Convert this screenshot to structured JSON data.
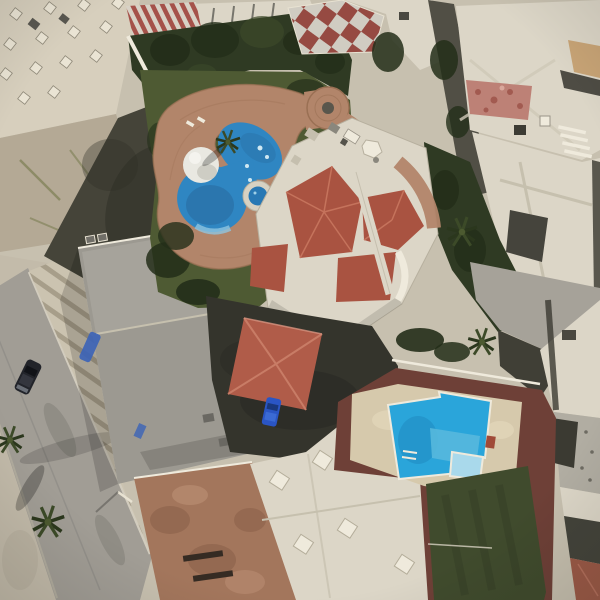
{
  "meta": {
    "title": "Aerial satellite view of a residential block with a resort-style pool, villa with red tile roofs, and a second backyard pool",
    "type": "satellite-photo",
    "width": 600,
    "height": 600
  },
  "scene": {
    "landmarks": [
      {
        "name": "resort-pool",
        "description": "Free-form blue swimming pool with white dome palapa and round spa"
      },
      {
        "name": "pool-deck",
        "description": "Terracotta brick pool deck with circular plaza and fountain"
      },
      {
        "name": "villa",
        "description": "White villa with red tile hip roofs and rooftop terraces"
      },
      {
        "name": "tree-garden",
        "description": "Dense dark green tree garden north of the pool"
      },
      {
        "name": "checkerboard-patio",
        "description": "Red and white checkerboard patio at top center"
      },
      {
        "name": "street",
        "description": "Gray street along the west side with a parked dark sedan and palm trees"
      },
      {
        "name": "striped-sidewalk",
        "description": "Wide sidewalk with diagonal paving stripes"
      },
      {
        "name": "gray-rooftop",
        "description": "Large flat gray rooftop building beside the street"
      },
      {
        "name": "red-pavilion",
        "description": "Red hip-roof pavilion over a dark driveway with a blue car"
      },
      {
        "name": "second-pool",
        "description": "Bright blue backyard pool with steps on a tan deck"
      },
      {
        "name": "turf-lawn",
        "description": "Dark green artificial turf lawn bordered by maroon walkways"
      },
      {
        "name": "white-rooftops",
        "description": "Flat white rooftops with water tanks and parapet walls"
      },
      {
        "name": "brown-rooftop",
        "description": "Mottled brown rooftop with dark vent slots"
      },
      {
        "name": "pink-roof-patch",
        "description": "Mottled pink tiled patch on a white roof, upper right"
      }
    ],
    "colors": {
      "base": "#c7c0af",
      "road": "#a19d95",
      "roadEdge": "#d8d2c3",
      "sidewalk": "#c3bbaa",
      "stripeLight": "#cbc3b0",
      "stripeDark": "#a79e8a",
      "tanRoof": "#d7cfbd",
      "ventLight": "#eae4d4",
      "acDark": "#595750",
      "weathered": "#b4a995",
      "moss": "#7c7f53",
      "darkShadow": "#454439",
      "darkest": "#2d2d26",
      "grayRoof": "#9c9991",
      "grayRoofLight": "#adaaa1",
      "garden": "#2f3a23",
      "gardenDark": "#232e19",
      "gardenLight": "#3c4929",
      "grass": "#4e5a33",
      "brick": "#b2856a",
      "brickDark": "#9a7054",
      "poolBlue": "#2f86c2",
      "poolDeep": "#28699f",
      "poolLight": "#8fc4e0",
      "poolFoam": "#cfe8f2",
      "domeWhite": "#e9e8e1",
      "domeShade": "#bcbbb1",
      "white": "#dcd6c7",
      "whiteBright": "#efeadc",
      "parapet": "#c6c0ae",
      "villaRed": "#a95341",
      "villaRedLight": "#c5735c",
      "pavilionRed": "#b05c49",
      "pavilionRidge": "#c87c66",
      "checkerRed": "#964a42",
      "checkerWhite": "#d0ccc2",
      "pinkPatch": "#bd8176",
      "pinkDark": "#a25a50",
      "maroon": "#6e4037",
      "turf": "#404b2d",
      "turfDark": "#333d24",
      "deck2": "#d6c9ac",
      "deck2Light": "#e3d7ba",
      "pool2Blue": "#2aa5da",
      "pool2Light": "#a9d9eb",
      "pool2Mid": "#57b8dd",
      "pool2Deep": "#1d86bb",
      "carDark": "#22242a",
      "carBlue": "#2a55c4",
      "carBlueDark": "#16336e",
      "speckle": "#b1ada2",
      "brownRoof": "#a3765c",
      "brownDark": "#865c45",
      "brownLight": "#c29579",
      "palm": "#3c4a28",
      "palmDark": "#2b371d",
      "tanDirt": "#c8a476",
      "redCorner": "#9c5a47",
      "alley": "#514f45",
      "pavement": "#a6a299",
      "darkStrip": "#3b3a32",
      "slotDark": "#352b23",
      "redItem": "#a04a38",
      "blueTarp": "#3b63b8",
      "poleLight": "#e8e2d2"
    }
  }
}
